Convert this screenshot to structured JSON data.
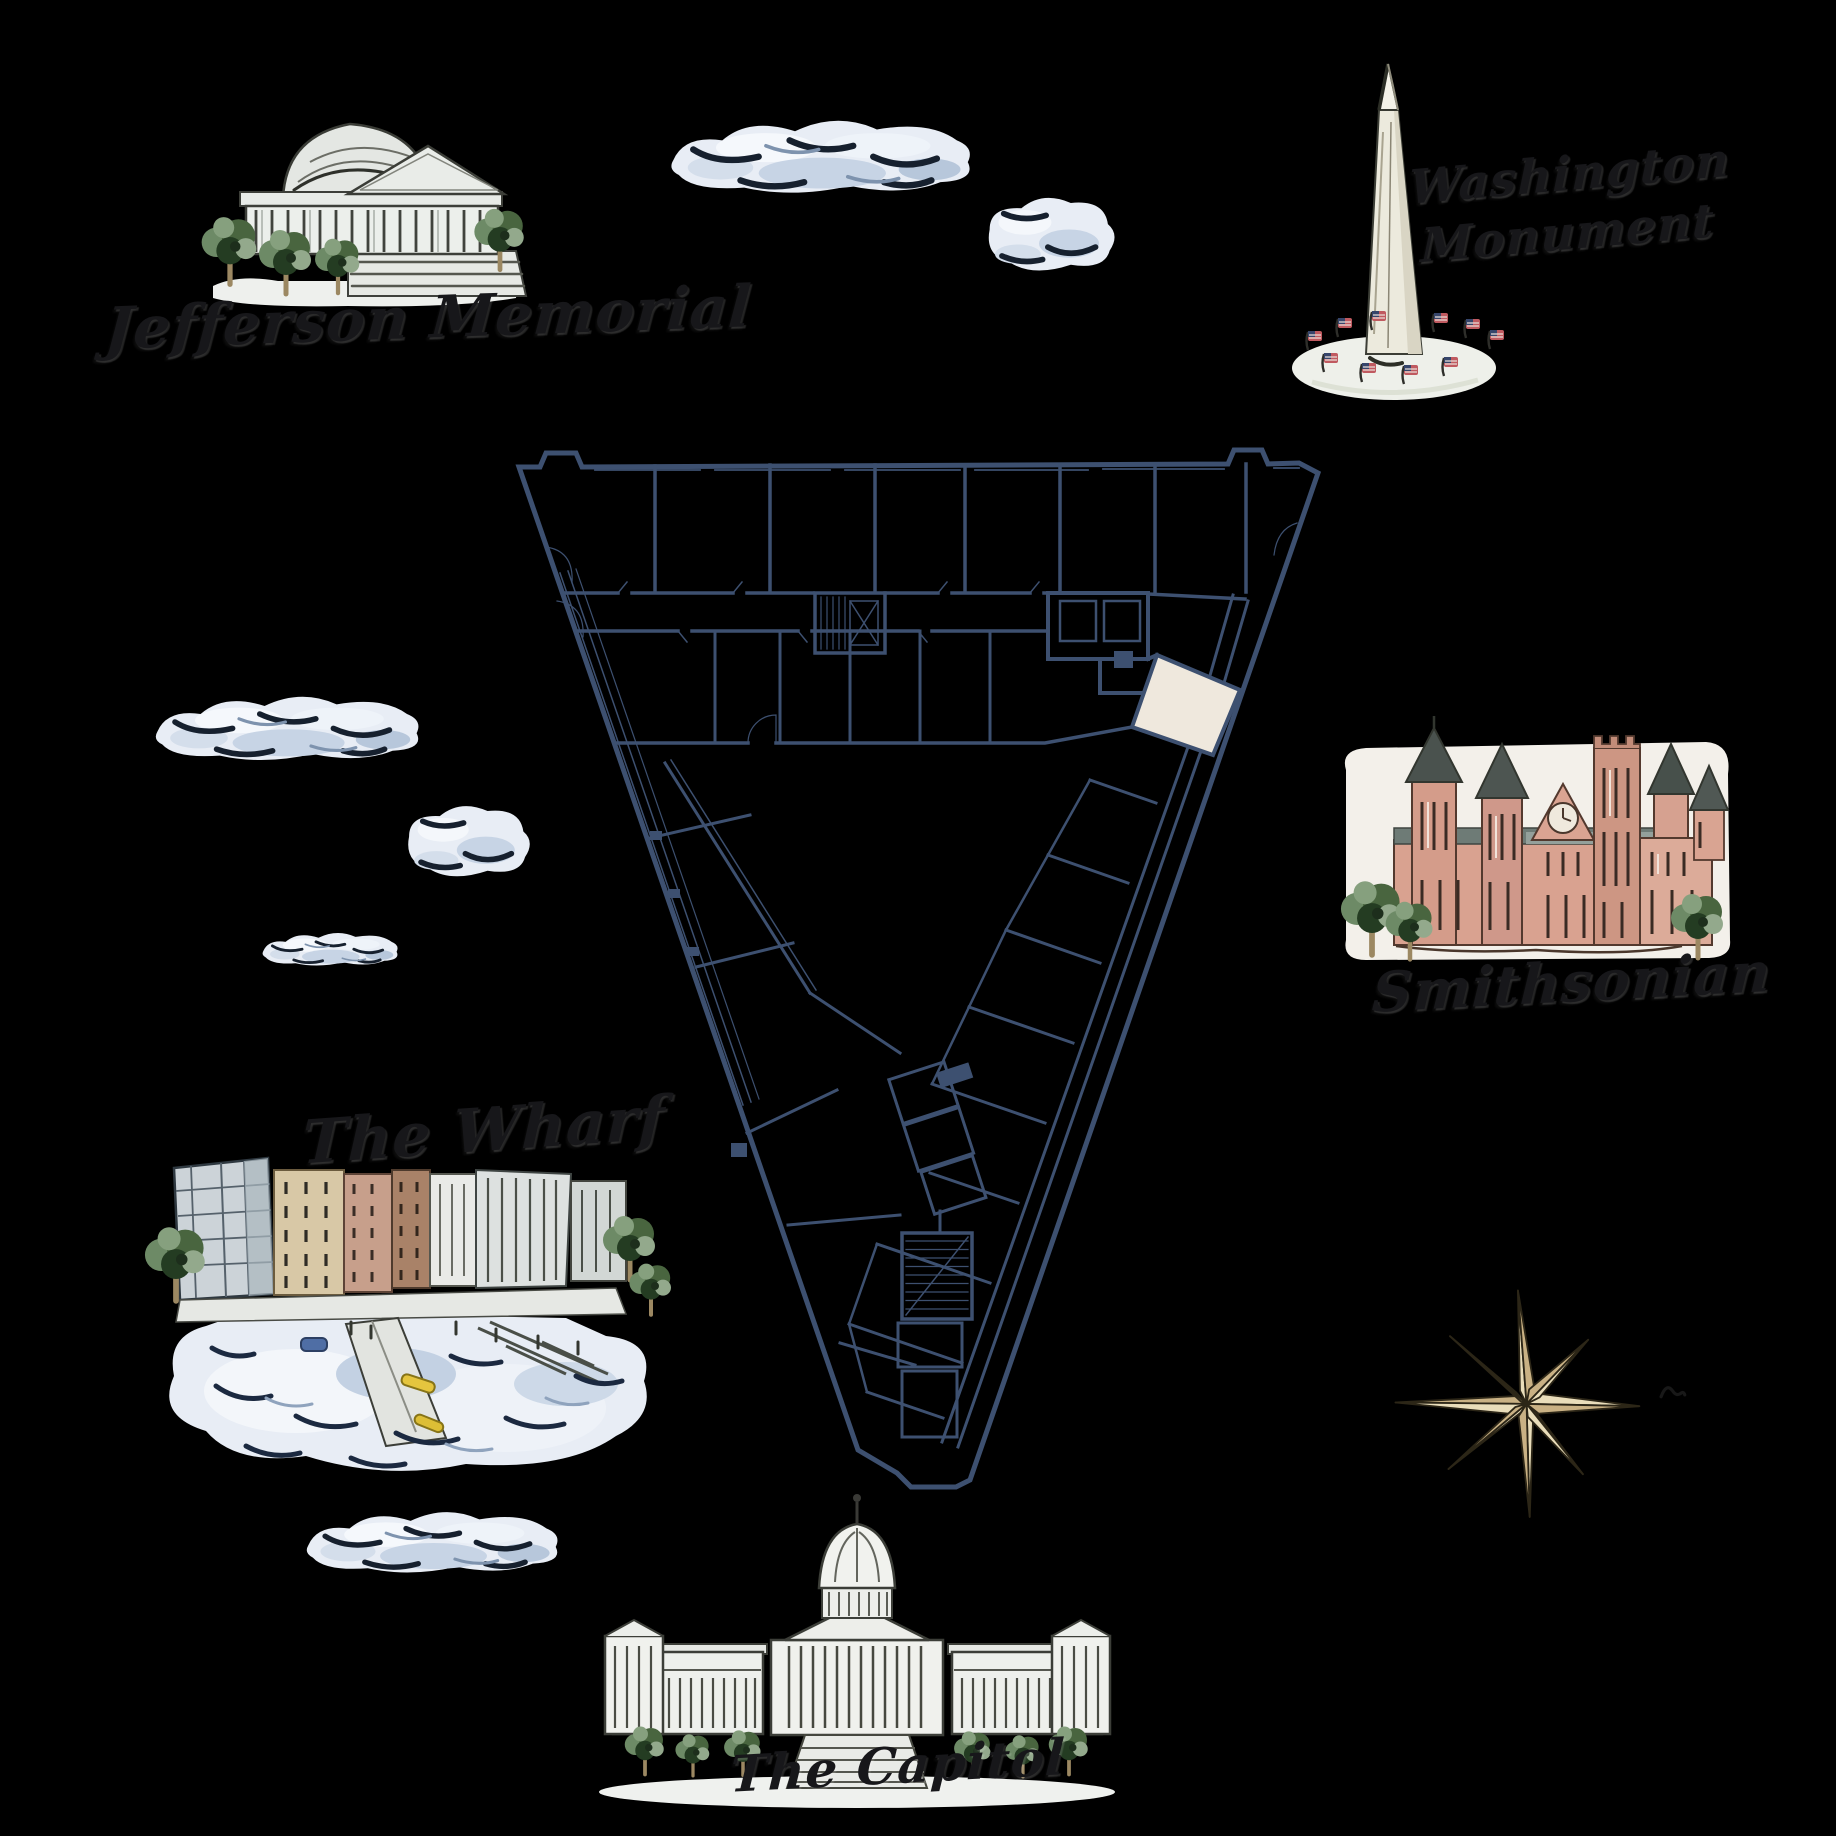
{
  "scene": {
    "background_color": "#000000"
  },
  "labels": {
    "jefferson_memorial": "Jefferson Memorial",
    "washington_monument_lines": [
      "Washington",
      "Monument"
    ],
    "smithsonian": "Smithsonian",
    "the_wharf": "The Wharf",
    "the_capitol": "The Capitol"
  },
  "floor_plan": {
    "wall_color": "#3d5070",
    "highlighted_room_color": "#efe8dd"
  },
  "compass_rose": {
    "fill_light": "#e9ddba",
    "fill_dark": "#c9b184",
    "outline": "#2c2617"
  },
  "clouds": {
    "count": 6,
    "fill": "#e8edf5",
    "stroke": "#16202e"
  },
  "palette": {
    "stone": "#eceeeb",
    "tree_green": "#49653f",
    "smithsonian_brick": "#d9a290",
    "water_blue": "#e8edf5",
    "kayak_yellow": "#e5c53e",
    "flag_red": "#c05a60",
    "flag_blue": "#36456b"
  }
}
